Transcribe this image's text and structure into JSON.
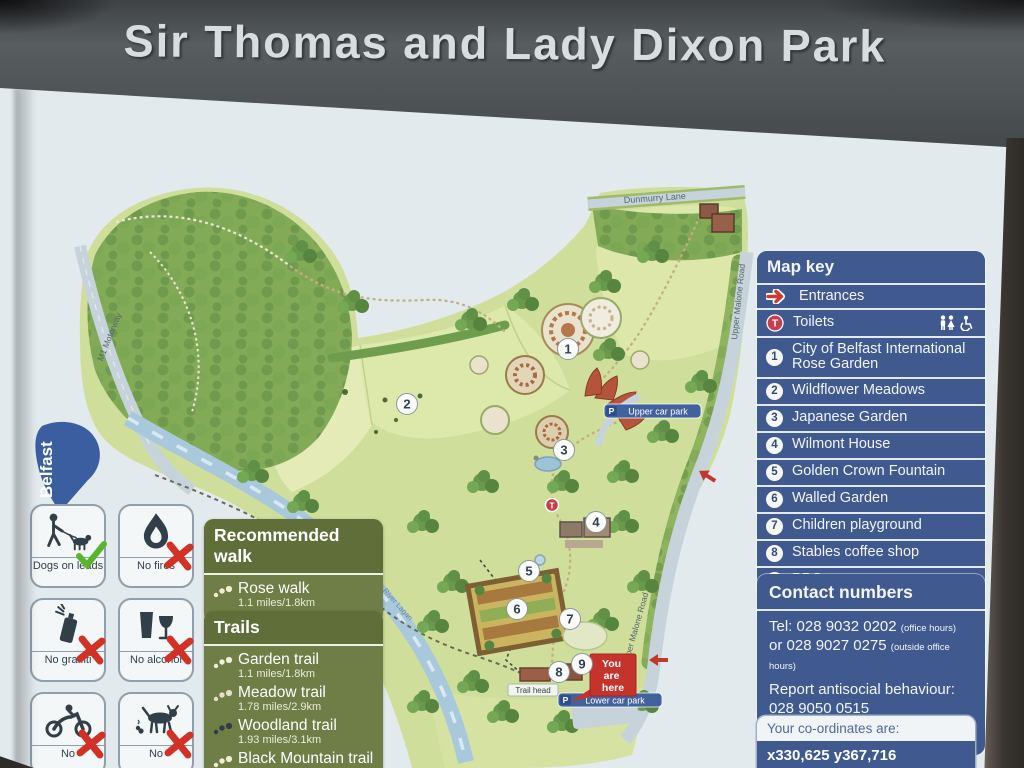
{
  "sign": {
    "title": "Sir Thomas and Lady Dixon Park"
  },
  "logo": {
    "text": "Belfast"
  },
  "rules": [
    {
      "label": "Dogs on leads",
      "icon": "dog-on-lead",
      "status": "allowed"
    },
    {
      "label": "No fires",
      "icon": "fire",
      "status": "prohibited"
    },
    {
      "label": "No graffiti",
      "icon": "spray-can",
      "status": "prohibited"
    },
    {
      "label": "No alcohol",
      "icon": "drinks",
      "status": "prohibited"
    },
    {
      "label": "No",
      "icon": "motorcycle",
      "status": "prohibited"
    },
    {
      "label": "No",
      "icon": "dog-fouling",
      "status": "prohibited"
    }
  ],
  "recommended_walk": {
    "title": "Recommended walk",
    "name": "Rose walk",
    "distance": "1.1 miles/1.8km"
  },
  "trails": {
    "title": "Trails",
    "items": [
      {
        "name": "Garden trail",
        "distance": "1.1 miles/1.8km"
      },
      {
        "name": "Meadow trail",
        "distance": "1.78 miles/2.9km"
      },
      {
        "name": "Woodland trail",
        "distance": "1.93 miles/3.1km"
      },
      {
        "name": "Black Mountain trail",
        "distance": "10 miles/16 km"
      }
    ]
  },
  "map_key": {
    "title": "Map key",
    "entrances_label": "Entrances",
    "toilets_label": "Toilets",
    "items": [
      {
        "num": "1",
        "label": "City of Belfast International Rose Garden"
      },
      {
        "num": "2",
        "label": "Wildflower Meadows"
      },
      {
        "num": "3",
        "label": "Japanese Garden"
      },
      {
        "num": "4",
        "label": "Wilmont House"
      },
      {
        "num": "5",
        "label": "Golden Crown Fountain"
      },
      {
        "num": "6",
        "label": "Walled Garden"
      },
      {
        "num": "7",
        "label": "Children playground"
      },
      {
        "num": "8",
        "label": "Stables coffee shop"
      },
      {
        "num": "9",
        "label": "BBQ area"
      }
    ]
  },
  "contact": {
    "title": "Contact numbers",
    "tel_line1": "Tel: 028 9032 0202",
    "tel_line1_note": "(office hours)",
    "tel_line2": "or 028 9027 0275",
    "tel_line2_note": "(outside office hours)",
    "report_line1": "Report antisocial behaviour:",
    "report_line2": "028 9050 0515",
    "emergency": "In an emergency, dial 999"
  },
  "coordinates": {
    "title": "Your co-ordinates are:",
    "value": "x330,625 y367,716"
  },
  "map": {
    "labels": {
      "dunmurry_lane": "Dunmurry Lane",
      "upper_malone_road": "Upper Malone Road",
      "m1_motorway": "M1 Motorway",
      "river_lagan": "River Lagan",
      "upper_car_park": "Upper car park",
      "lower_car_park": "Lower car park",
      "trail_head": "Trail head"
    },
    "you_are_here_lines": [
      "You",
      "are",
      "here"
    ],
    "p_symbol": "P",
    "toilet_symbol": "T",
    "markers": [
      {
        "num": "1"
      },
      {
        "num": "2"
      },
      {
        "num": "3"
      },
      {
        "num": "4"
      },
      {
        "num": "5"
      },
      {
        "num": "6"
      },
      {
        "num": "7"
      },
      {
        "num": "8"
      },
      {
        "num": "9"
      }
    ]
  },
  "colors": {
    "panel_navy": "#40598f",
    "panel_olive": "#6f7d46",
    "red_marker": "#c4342c",
    "check_green": "#58b52c",
    "cross_red": "#d23126",
    "header_grey": "#4d5255"
  }
}
